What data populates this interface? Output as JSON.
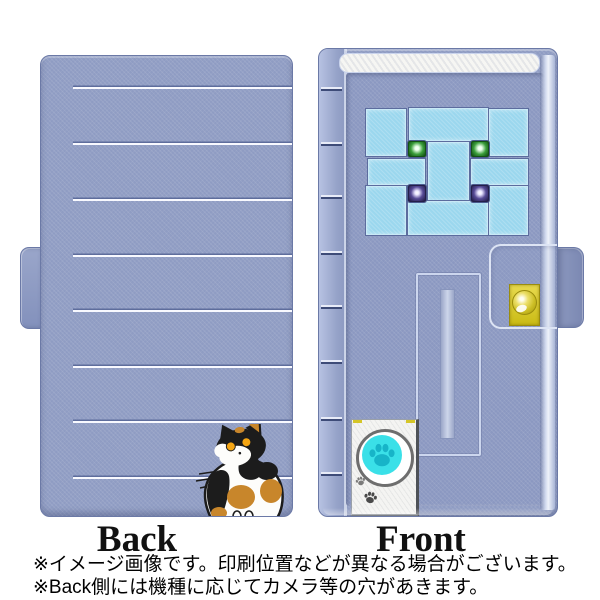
{
  "product": {
    "type": "flip phone case product image",
    "views": {
      "back": "Back",
      "front": "Front"
    }
  },
  "labels": {
    "back": "Back",
    "front": "Front"
  },
  "notes": {
    "line1": "※イメージ画像です。印刷位置などが異なる場合がございます。",
    "line2": "※Back側には機種に応じてカメラ等の穴があきます。"
  },
  "design": {
    "back_view": {
      "motif": "house siding with calico cat",
      "siding_line_count": 8,
      "cat": "calico cat (white / black / orange, amber eyes) sitting at bottom right"
    },
    "front_view": {
      "motif": "front door",
      "window_pane_count": 9,
      "gems": [
        "green",
        "green",
        "purple",
        "purple"
      ],
      "elements": [
        "white transom bar",
        "stained-glass window grid",
        "mail slot",
        "gold doorknob on flap",
        "doorbell plate with cyan paw button",
        "two small paw prints"
      ]
    },
    "colors": {
      "page_bg": "#ffffff",
      "case_base": "#8f9cc3",
      "case_border": "#6b79a6",
      "door_face": "#8b98c1",
      "transom_white": "#f6f6f3",
      "glass": "#9bd7ee",
      "glass_border": "#c9e9f6",
      "mullion_dark": "#5c6c9e",
      "gem_green": "#3a9e3a",
      "gem_green_dark": "#145214",
      "gem_purple": "#564a96",
      "gem_purple_dark": "#241f4a",
      "slot_outline": "#ccd6ee",
      "flap_outline": "#dde4f4",
      "knob_plate": "#d5c628",
      "knob_plate_dark": "#9a8c0e",
      "bell_box": "#f4f4f2",
      "bell_ring": "#6e6e6e",
      "bell_cyan": "#3ae0e8",
      "bell_paw": "#17b4c8",
      "paw_gray": "#4a4a4a",
      "line_white": "#f8f9ff",
      "line_dark": "#5e6d9c",
      "spine_band_light": "#e8ecf8",
      "spine_band_dark": "#3e4c78",
      "cat_white": "#fdfdfb",
      "cat_black": "#1c1c1c",
      "cat_orange": "#c8862b",
      "cat_eye": "#f4a513",
      "label_color": "#111111",
      "note_color": "#000000"
    }
  }
}
